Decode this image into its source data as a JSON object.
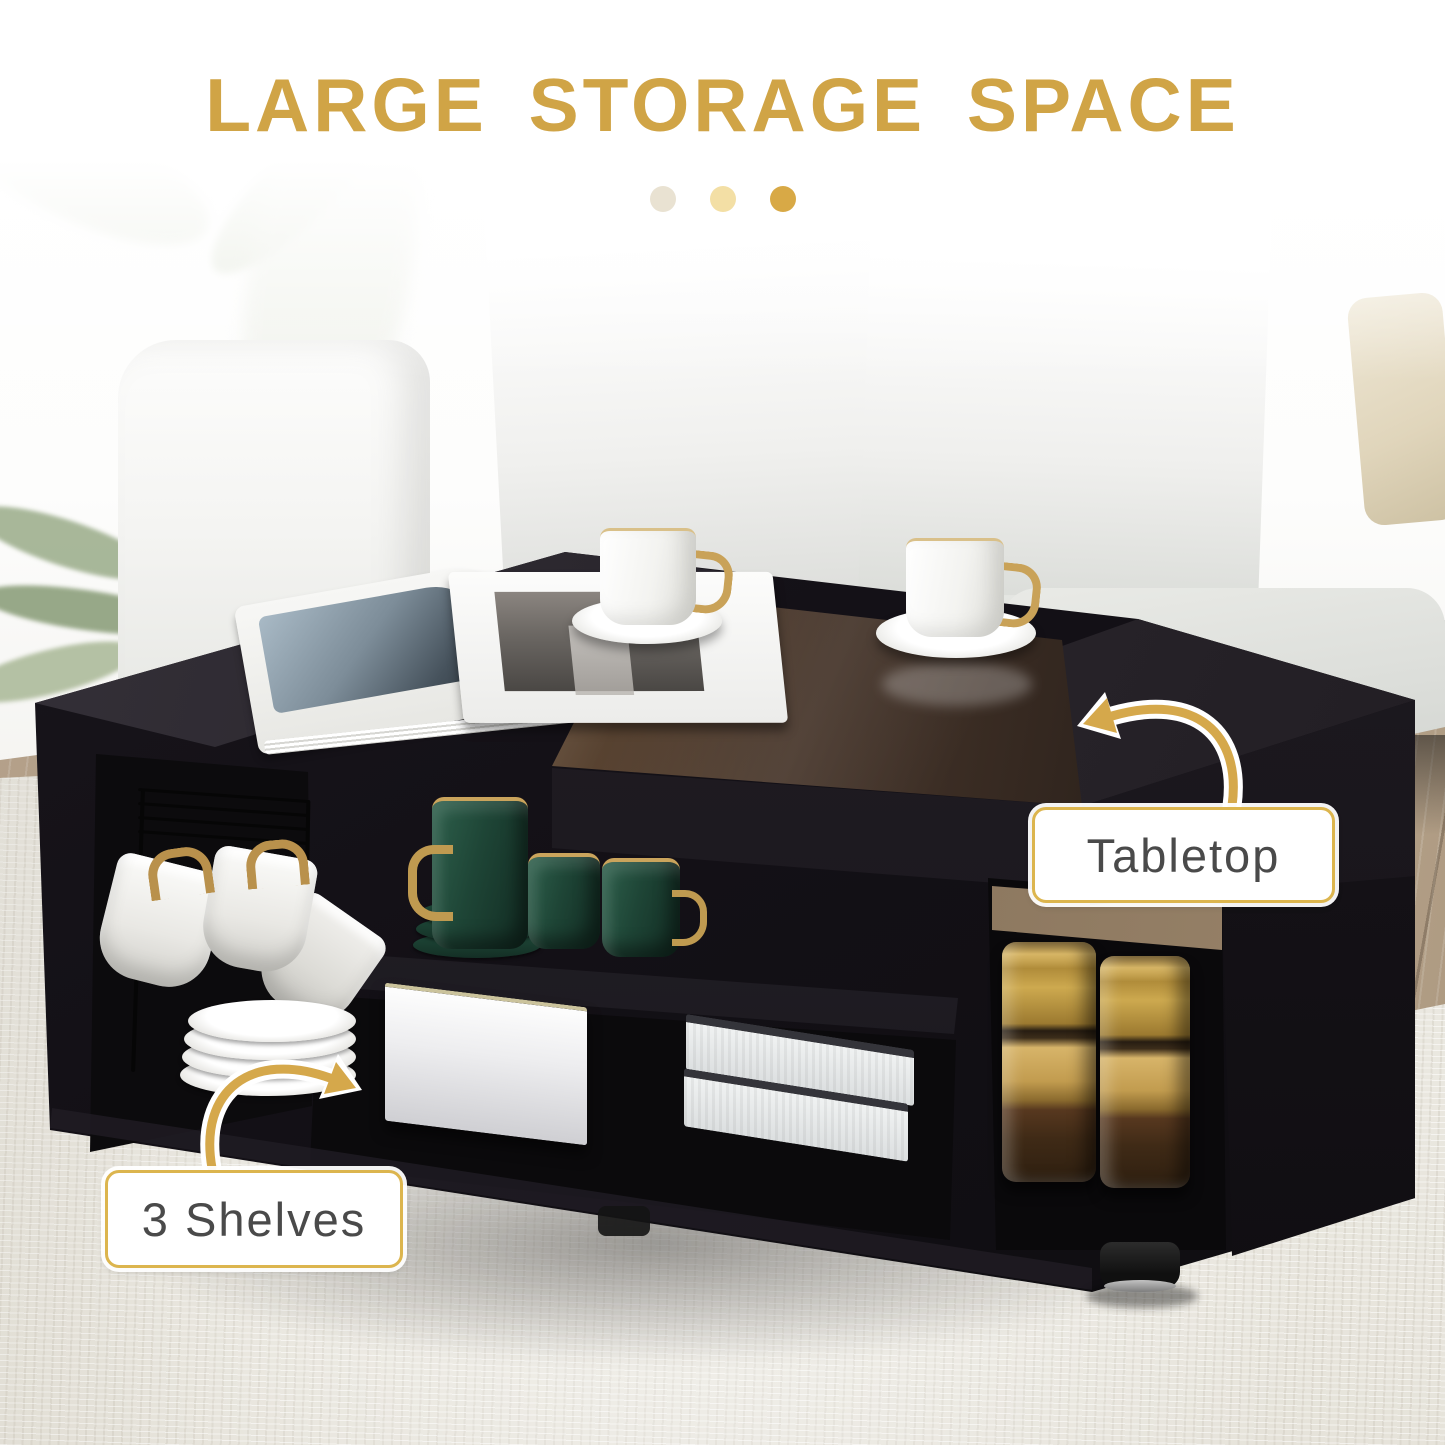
{
  "image_role": "product-feature-graphic",
  "title": {
    "text": "LARGE STORAGE SPACE",
    "color": "#D0A446"
  },
  "decor_dots": {
    "colors": [
      "#E9E2D2",
      "#F3DFA5",
      "#D8A946"
    ]
  },
  "callouts": {
    "tabletop": {
      "label": "Tabletop"
    },
    "shelves": {
      "label": "3 Shelves"
    }
  },
  "style": {
    "accent_gold": "#D5A84B",
    "arrow_outline": "#FFFFFF",
    "callout_border": "#DCB54E",
    "callout_text": "#4A4A4A",
    "callout_bg": "#FFFFFF"
  },
  "scene": {
    "objects": [
      "sofa",
      "throw-pillows",
      "plant-leaves",
      "open-magazine",
      "white-teacups-with-gold-handles",
      "brown-glass-tabletop",
      "black-coffee-table",
      "green-mug-set",
      "hanging-cup-rack",
      "plate-stack",
      "white-storage-box",
      "document-stack",
      "gold-coffee-jars",
      "adjustable-foot",
      "area-rug",
      "wood-floor"
    ],
    "colors": {
      "sofa": "#D8DBD6",
      "table": "#17141A",
      "glass_tint": "#6E5138",
      "rug": "#EDEAE2",
      "wood_floor": "#B09D86"
    }
  }
}
